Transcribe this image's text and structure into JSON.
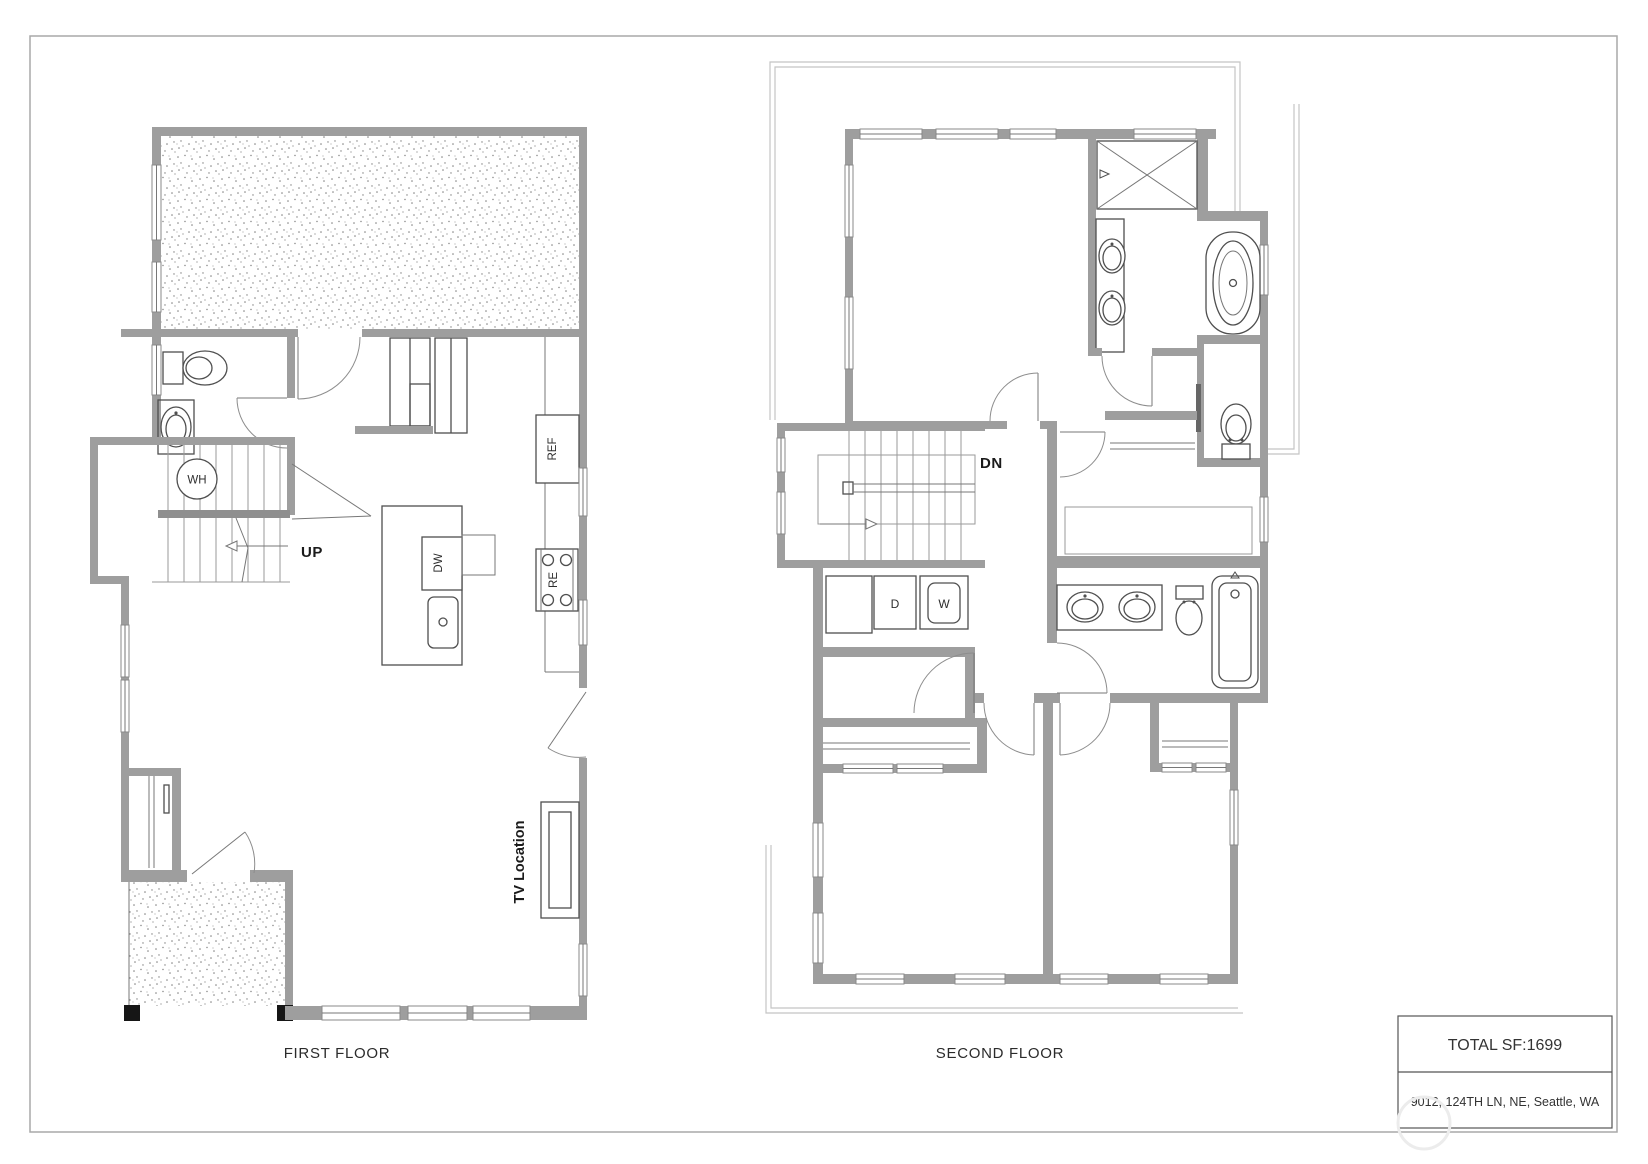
{
  "document": {
    "kind": "residential floor plan sheet"
  },
  "first_floor": {
    "title": "FIRST FLOOR",
    "labels": {
      "water_heater": "WH",
      "direction": "UP",
      "refrigerator": "REF",
      "dishwasher": "DW",
      "range": "RE",
      "tv_location": "TV Location"
    }
  },
  "second_floor": {
    "title": "SECOND FLOOR",
    "labels": {
      "direction": "DN",
      "dryer": "D",
      "washer": "W"
    }
  },
  "title_block": {
    "total_sf": "TOTAL SF:1699",
    "address": "9012, 124TH LN, NE, Seattle, WA"
  },
  "colors": {
    "wall": "#9e9e9e",
    "line": "#4f4f4f",
    "roof": "#c4c4c4",
    "text": "#1b1b1b",
    "border": "#a8a8a8"
  }
}
